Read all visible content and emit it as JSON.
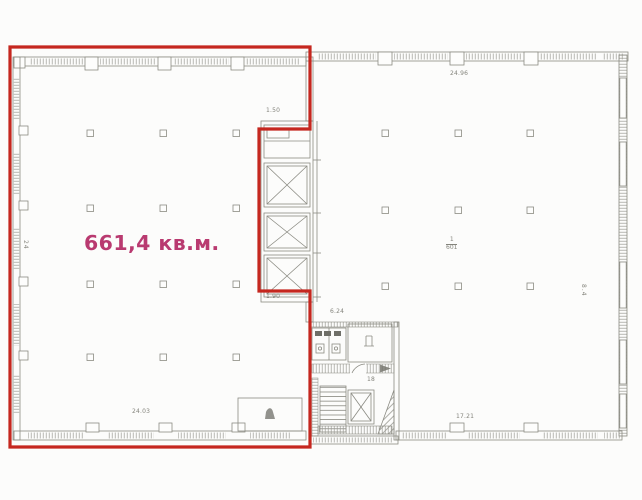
{
  "colors": {
    "highlight": "#c5271f",
    "area_text": "#b93a70"
  },
  "plan": {
    "highlighted_unit": {
      "area_label": "661,4 кв.м.",
      "dim_notch_top": "1.50",
      "dim_notch_bottom": "1.90",
      "dim_bottom": "24.03",
      "dim_left_vertical": "24"
    },
    "right_unit": {
      "room_number": "1",
      "room_area": "601",
      "dim_top": "24.96",
      "dim_bottom": "17.21",
      "dim_right_vertical": "8.4"
    },
    "service_core": {
      "dim_wc": "6.24",
      "stair_label": "18"
    }
  }
}
